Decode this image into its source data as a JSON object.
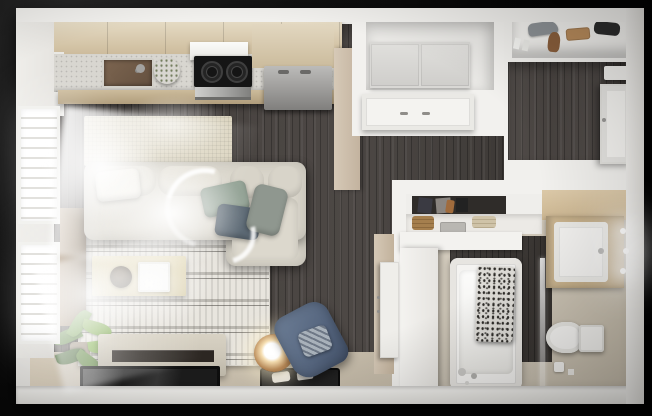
{
  "meta": {
    "title": "3D top-down floor plan render of a studio apartment",
    "view": "dollhouse overhead view on black background",
    "canvas": {
      "width": 652,
      "height": 416
    }
  },
  "palette": {
    "wall": "#f2f1ee",
    "floorWood": "#484340",
    "floorTan": "#cfc7b8",
    "bottomStrip": "#d0c6b4",
    "cabinetWood": "#d2c2a4",
    "counter": "#d8d6d0",
    "counterFront": "#ccbb9b",
    "sinkBronze": "#64503f",
    "bowlGreen": "#a4c233",
    "cooktop": "#151515",
    "oven": "#a9a9a7",
    "fridge": "#9c9b99",
    "laundryCabinet": "#d9d8d5",
    "runnerRug": "#dbd4bf",
    "rug": "#e8e5de",
    "rugStripe": "#bab7b0",
    "sofa": "#d9d5ca",
    "pillowTeal": "#95a497",
    "pillowSlate": "#5d6a75",
    "pillowGray": "#8f978f",
    "coffeeTable": "#d6cba6",
    "sideboard": "#7c6950",
    "plantGreen": "#6b9346",
    "bench": "#c3bdae",
    "benchShelf": "#2c2722",
    "tv": "#1c1c1c",
    "tray": "#222222",
    "lampWood": "#b98a58",
    "chairBlue": "#55657e",
    "chairPillow": "#a8b1ba",
    "tileDark": "#3e3a37",
    "tub": "#f4f3f1",
    "curtainBase": "#dddbd6",
    "toilet": "#f6f5f3",
    "vanityWood": "#ccb691",
    "vanitySink": "#f2f1ef",
    "doorTan": "#c3b39f",
    "door": "#efeeea"
  },
  "rooms": [
    {
      "name": "kitchen",
      "position": "top-left",
      "items": [
        "upper-cabinets",
        "countertop",
        "sink",
        "faucet",
        "green-fruit-bowl",
        "range-hood",
        "cooktop",
        "oven",
        "refrigerator"
      ]
    },
    {
      "name": "living-room",
      "position": "left",
      "items": [
        "runner-rug",
        "striped-area-rug",
        "sectional-sofa",
        "throw-pillows",
        "coffee-table",
        "tray",
        "bowl",
        "window-sideboard",
        "potted-plant",
        "media-bench",
        "wall-tv",
        "decor-tray",
        "glowing-sphere-lamp",
        "blue-armchair",
        "two-windows-with-blinds",
        "sunlight-flares"
      ]
    },
    {
      "name": "laundry-closet",
      "position": "top-center",
      "items": [
        "double-door-cabinet",
        "closet-doors"
      ]
    },
    {
      "name": "entry",
      "position": "top-right",
      "items": [
        "shelf-with-bags-and-shoes",
        "front-door",
        "door-mat",
        "dark-wood-floor"
      ]
    },
    {
      "name": "bathroom",
      "position": "bottom-right",
      "items": [
        "closet-shelf-with-baskets",
        "hanging-clothes",
        "bathtub",
        "shower-curtain",
        "glass-panel",
        "taps",
        "toilet",
        "toilet-paper",
        "vanity-cabinet",
        "vanity-sink",
        "three-sconce-lights",
        "door"
      ]
    }
  ]
}
